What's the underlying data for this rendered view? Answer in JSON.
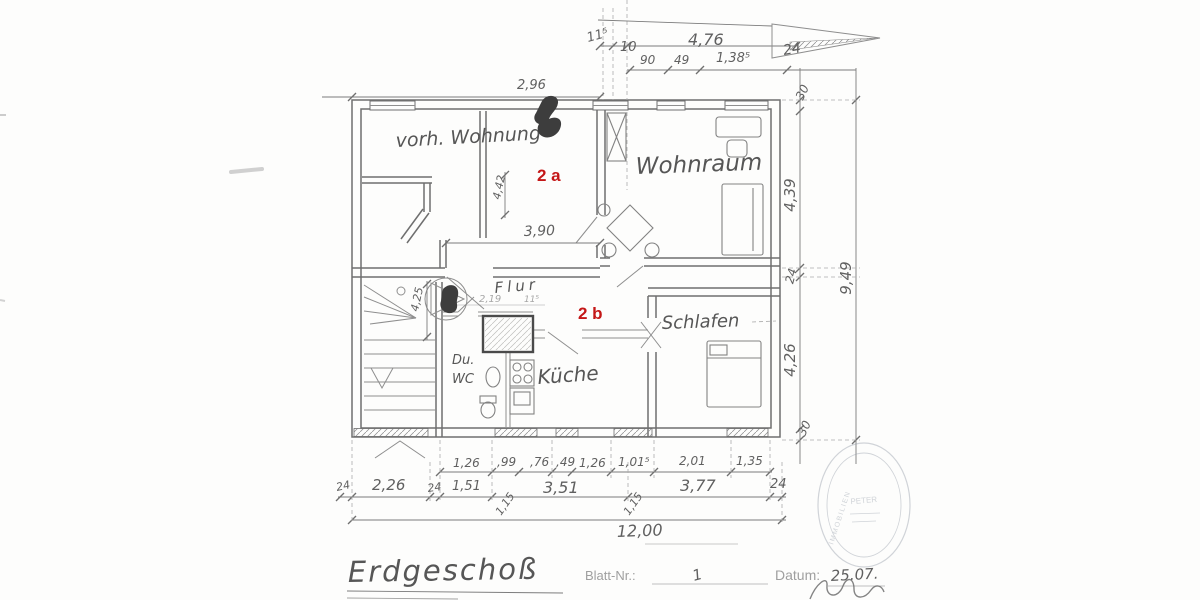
{
  "title_block": {
    "drawing_title": "Erdgeschoß",
    "sheet_label": "Blatt-Nr.:",
    "sheet_number": "1",
    "date_label": "Datum:",
    "date_value": "25.07."
  },
  "rooms": {
    "existing_flat": "vorh. Wohnung",
    "living_room": "Wohnraum",
    "hall": "Flur",
    "bedroom": "Schlafen",
    "shower": "Du.",
    "wc": "WC",
    "kitchen": "Küche"
  },
  "unit_marks": {
    "unit_a": "2 a",
    "unit_b": "2 b",
    "color": "#c41717"
  },
  "dims": {
    "top": {
      "offset": "11⁵",
      "ten": "10",
      "total": "4,76",
      "w90": "90",
      "w49": "49",
      "w138": "1,38⁵",
      "wall24": "24",
      "w296": "2,96"
    },
    "right": {
      "t30": "30",
      "h439": "4,39",
      "wall24": "24",
      "h426": "4,26",
      "b30": "30",
      "total": "9,49"
    },
    "inner": {
      "w442": "4,42",
      "w390": "3,90",
      "h425": "4,25",
      "w219": "2,19",
      "w115": "11⁵"
    },
    "bottom_row1": [
      "1,26",
      ",99",
      ",76",
      ",49",
      "1,26",
      "1,01⁵",
      "2,01",
      "1,35"
    ],
    "bottom_row2": [
      "24",
      "2,26",
      "24",
      "1,51",
      "3,51",
      "3,77",
      "24"
    ],
    "bottom_diag": [
      "1,15",
      "1,15"
    ],
    "bottom_total": "12,00"
  },
  "stamp": {
    "rim_text": "IMMOBILIEN",
    "center_text": "PETER"
  }
}
